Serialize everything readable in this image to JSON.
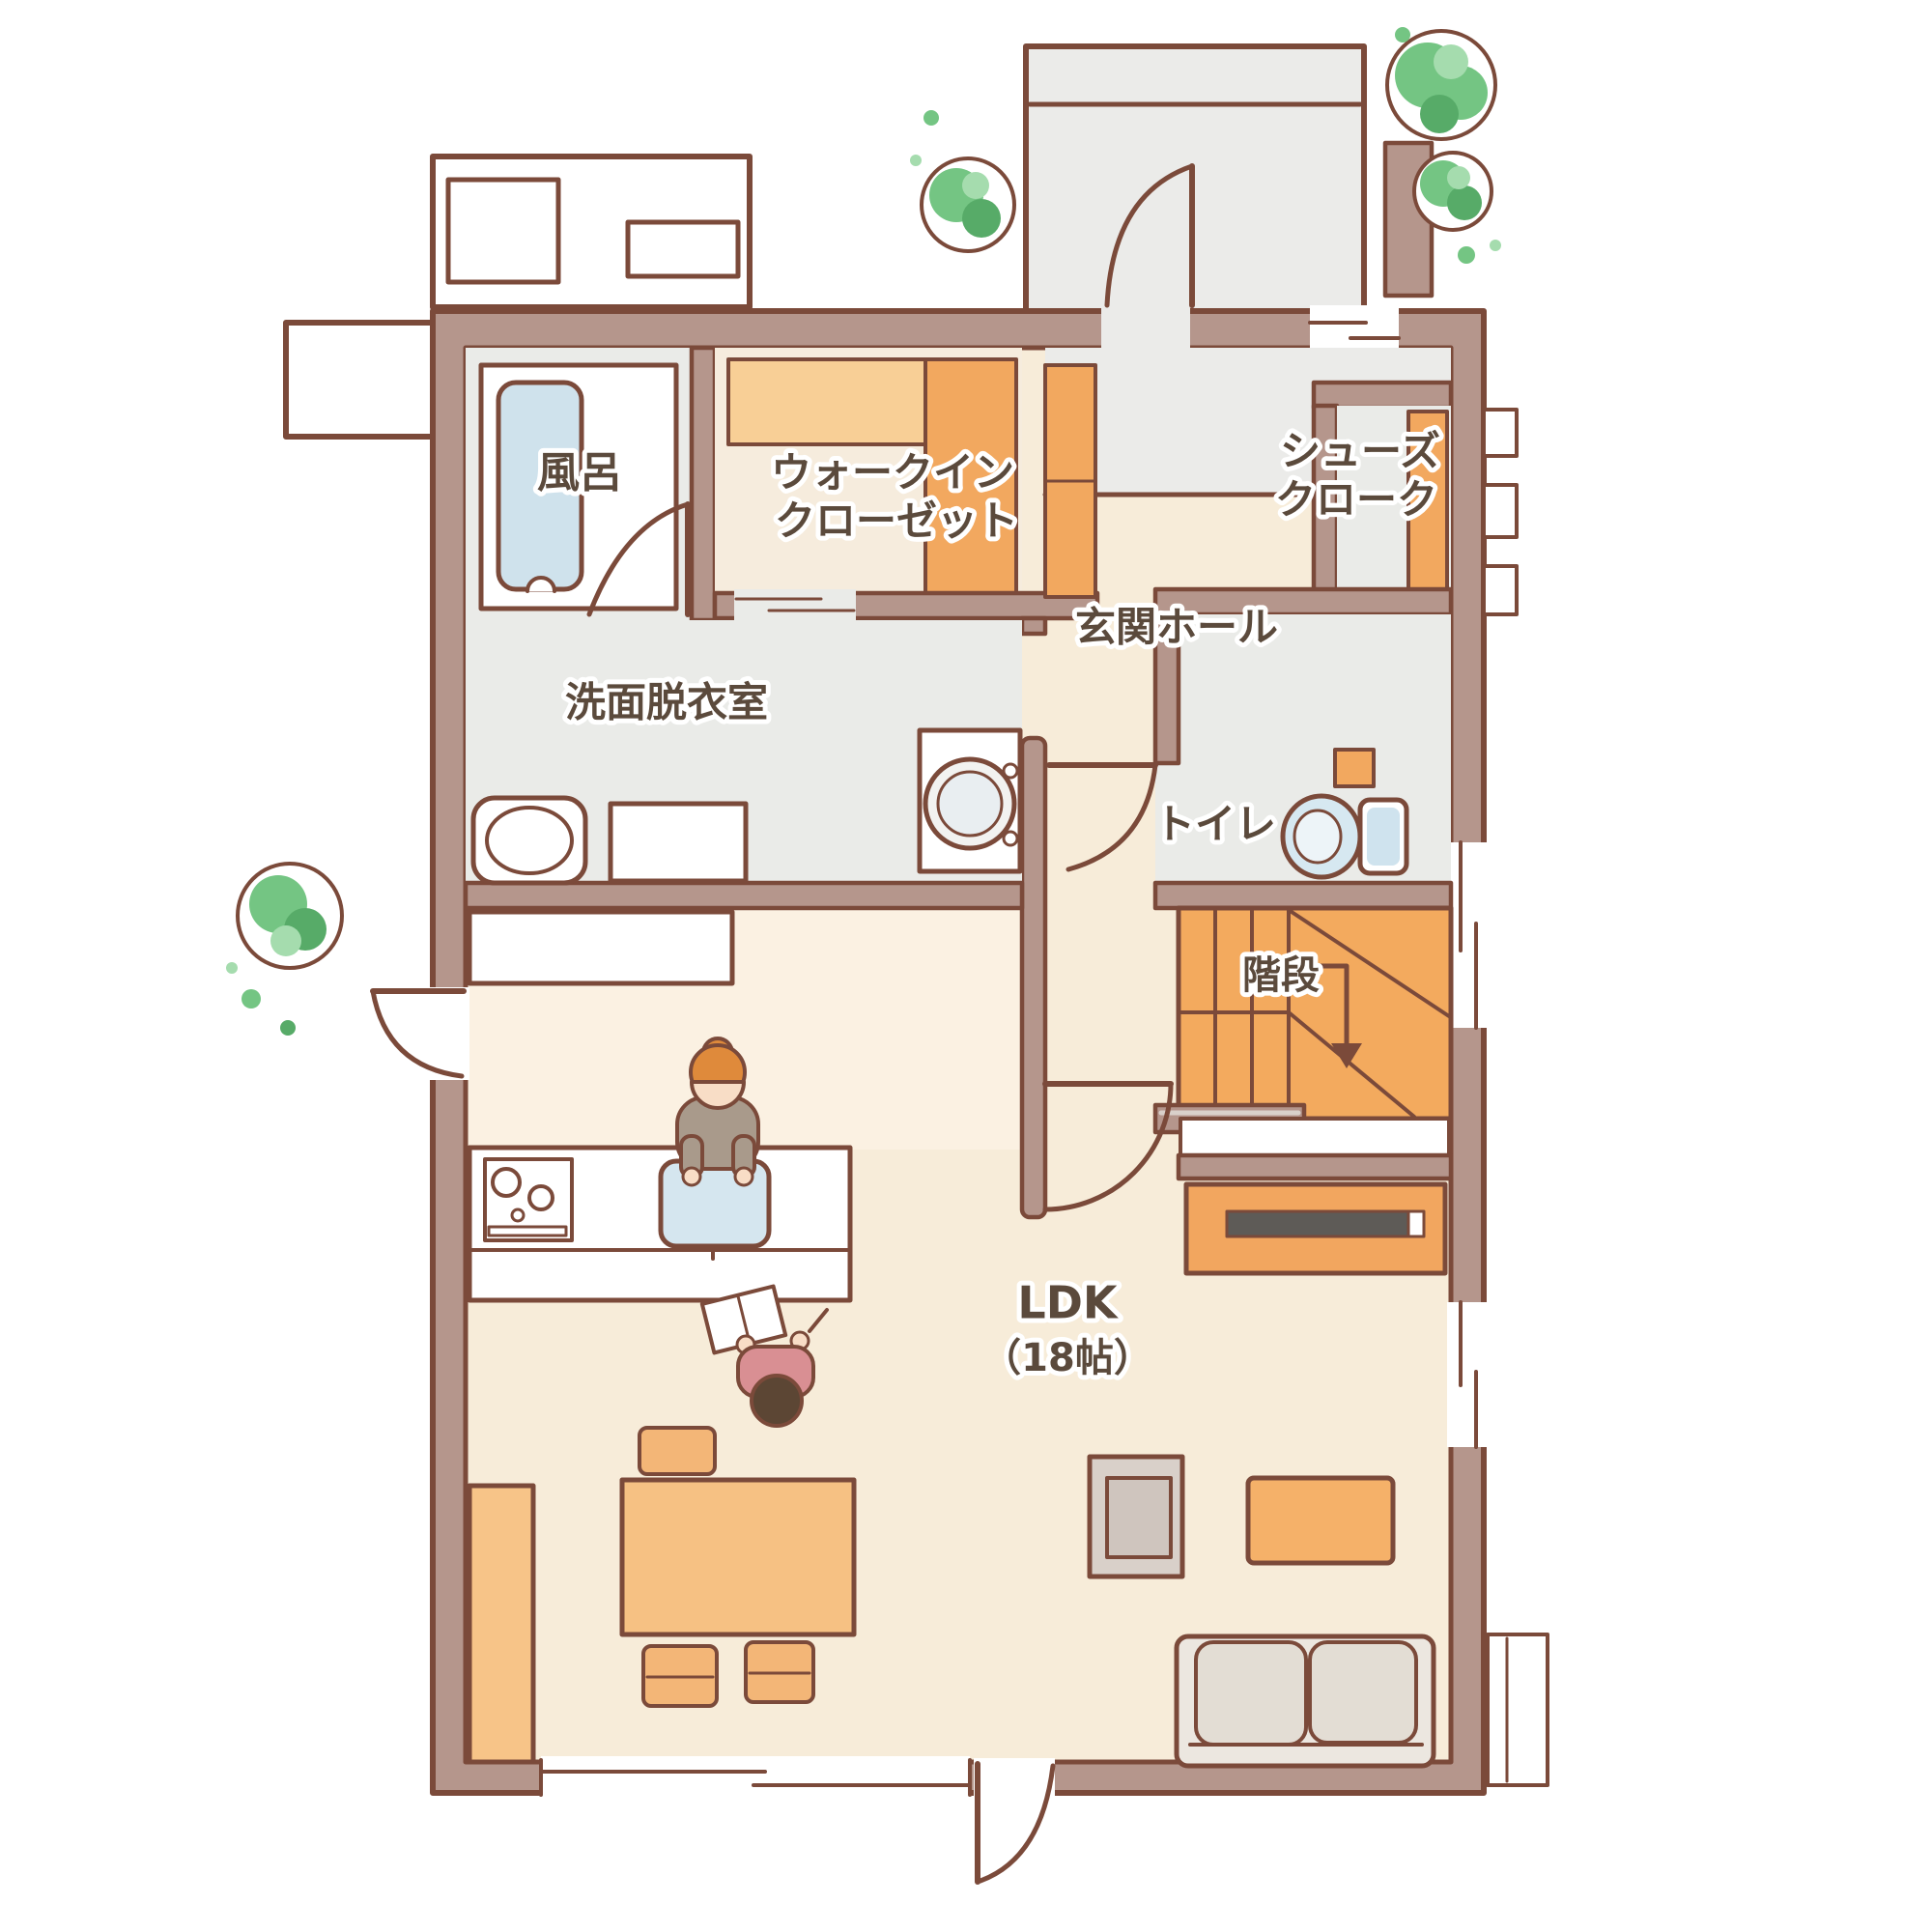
{
  "title": "1F floor plan (hand-drawn)",
  "rooms": {
    "bath": {
      "label": "風呂"
    },
    "walk_in_closet": {
      "line1": "ウォークイン",
      "line2": "クローゼット"
    },
    "shoes_cloak": {
      "line1": "シューズ",
      "line2": "クローク"
    },
    "entrance_hall": {
      "label": "玄関ホール"
    },
    "washroom": {
      "label": "洗面脱衣室"
    },
    "toilet": {
      "label": "トイレ"
    },
    "stairs": {
      "label": "階段"
    },
    "ldk": {
      "label": "LDK",
      "size": "（18帖）"
    }
  },
  "colors": {
    "wall_fill": "#b5968c",
    "wall_line": "#7b4a3a",
    "floor_beige": "#f7ecd9",
    "floor_gray": "#eaebe8",
    "entrance_tile": "#ebebe9",
    "furniture_orange": "#f2a85f",
    "shelf_orange_light": "#f8cf96",
    "water_blue": "#cfe2ec",
    "tree_green": "#74c583",
    "tree_green_dark": "#57ab68",
    "tree_green_light": "#a5dcae",
    "tv_screen": "#5e5b57",
    "label_text": "#5b4a3c"
  }
}
